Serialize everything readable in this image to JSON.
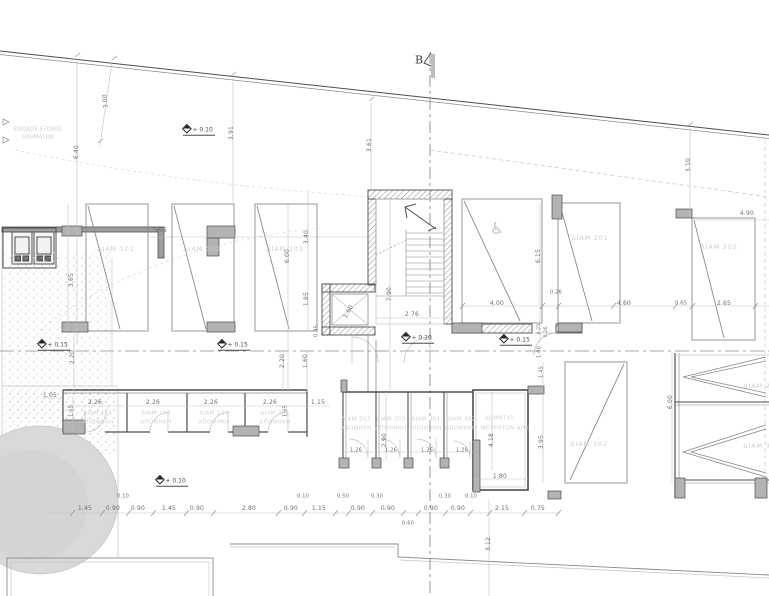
{
  "drawing": {
    "kind": "architectural ground-floor parking / storage plan",
    "section_line_axis_x": 430
  },
  "colors": {
    "background": "#ffffff",
    "line_dark": "#4d4d4d",
    "line_medium": "#8a8a8a",
    "line_light": "#c2c2c2",
    "wall_fill": "#b3b3b3",
    "label_faint": "#cdcdcd",
    "dim_text": "#6e6e6e",
    "tree_fill": "#d9d9d9"
  },
  "layers": {
    "section": {
      "label": "B",
      "x": 419,
      "y": 60
    },
    "notes": [
      {
        "t": "ΕΙΣΟΔΟΣ-ΕΞΟΔΟΣ",
        "x": 38,
        "y": 130
      },
      {
        "t": "ΟΧΗΜΑΤΩΝ",
        "x": 38,
        "y": 138
      }
    ],
    "icons": [
      {
        "t": "♿",
        "x": 497,
        "y": 229
      }
    ],
    "parking_labels": [
      {
        "t": "ΔΙΑΜ 101",
        "x": 116,
        "y": 249
      },
      {
        "t": "ΔΙΑΜ 102",
        "x": 202,
        "y": 249
      },
      {
        "t": "ΔΙΑΜ 103",
        "x": 285,
        "y": 249
      },
      {
        "t": "ΔΙΑΜ 201",
        "x": 590,
        "y": 238
      },
      {
        "t": "ΔΙΑΜ 202",
        "x": 719,
        "y": 247
      },
      {
        "t": "ΔΙΑΜ 302",
        "x": 589,
        "y": 444
      },
      {
        "t": "ΔΙΑΜ 2",
        "x": 757,
        "y": 386
      },
      {
        "t": "ΔΙΑΜ 3",
        "x": 757,
        "y": 446
      }
    ],
    "storage_labels": [
      {
        "t": "ΔΙΑΜ 101",
        "x": 98,
        "y": 414
      },
      {
        "t": "ΑΠΟΘΗΚΗ",
        "x": 98,
        "y": 423
      },
      {
        "t": "ΔΙΑΜ 102",
        "x": 156,
        "y": 414
      },
      {
        "t": "ΑΠΟΘΗΚΗ",
        "x": 156,
        "y": 423
      },
      {
        "t": "ΔΙΑΜ 103",
        "x": 214,
        "y": 414
      },
      {
        "t": "ΑΠΟΘΗΚΗ",
        "x": 214,
        "y": 423
      },
      {
        "t": "ΔΙΑΜ 201",
        "x": 275,
        "y": 414
      },
      {
        "t": "ΑΠΟΘΗΚΗ",
        "x": 275,
        "y": 423
      },
      {
        "t": "ΔΙΑΜ 202",
        "x": 356,
        "y": 420
      },
      {
        "t": "ΑΠΟΘΗΚΗ",
        "x": 356,
        "y": 429
      },
      {
        "t": "ΔΙΑΜ 203",
        "x": 391,
        "y": 420
      },
      {
        "t": "ΑΠΟΘΗΚΗ",
        "x": 391,
        "y": 429
      },
      {
        "t": "ΔΙΑΜ 301",
        "x": 426,
        "y": 420
      },
      {
        "t": "ΑΠΟΘΗΚΗ",
        "x": 426,
        "y": 429
      },
      {
        "t": "ΔΙΑΜ 302",
        "x": 461,
        "y": 420
      },
      {
        "t": "ΑΠΟΘΗΚΗ",
        "x": 461,
        "y": 429
      },
      {
        "t": "ΔΩΜΑΤΙΟ",
        "x": 499,
        "y": 419
      },
      {
        "t": "ΜΕΤΡΗΤΩΝ ΑΗΚ",
        "x": 505,
        "y": 429
      }
    ],
    "levels": [
      {
        "t": "+ 0.10",
        "x": 183,
        "y": 130
      },
      {
        "t": "+ 0.15",
        "x": 38,
        "y": 345
      },
      {
        "t": "+ 0.15",
        "x": 218,
        "y": 345
      },
      {
        "t": "+ 0.15",
        "x": 500,
        "y": 340
      },
      {
        "t": "+ 0.20",
        "x": 402,
        "y": 338
      },
      {
        "t": "+ 0.10",
        "x": 156,
        "y": 481
      }
    ],
    "dimensions": [
      {
        "t": "6.40",
        "x": 77,
        "y": 152,
        "r": -90
      },
      {
        "t": "3.00",
        "x": 106,
        "y": 101,
        "r": -97
      },
      {
        "t": "3.91",
        "x": 232,
        "y": 133,
        "r": -90
      },
      {
        "t": "3.61",
        "x": 370,
        "y": 145,
        "r": -90
      },
      {
        "t": "3.10",
        "x": 689,
        "y": 165,
        "r": -90
      },
      {
        "t": "5.95",
        "x": 160,
        "y": 231
      },
      {
        "t": "3.65",
        "x": 72,
        "y": 280,
        "r": -90
      },
      {
        "t": "6.00",
        "x": 288,
        "y": 256,
        "r": -90
      },
      {
        "t": "3.40",
        "x": 307,
        "y": 237,
        "r": -90
      },
      {
        "t": "1.85",
        "x": 307,
        "y": 299,
        "r": -90
      },
      {
        "t": "7.90",
        "x": 390,
        "y": 294,
        "r": -90
      },
      {
        "t": "1.60",
        "x": 349,
        "y": 312,
        "r": -60
      },
      {
        "t": "2.76",
        "x": 412,
        "y": 315
      },
      {
        "t": "0.35",
        "x": 317,
        "y": 331,
        "r": -90,
        "c": "s"
      },
      {
        "t": "2.20",
        "x": 73,
        "y": 357,
        "r": -90
      },
      {
        "t": "2.20",
        "x": 283,
        "y": 361,
        "r": -90
      },
      {
        "t": "1.60",
        "x": 306,
        "y": 361,
        "r": -90
      },
      {
        "t": "1.05",
        "x": 50,
        "y": 396
      },
      {
        "t": "1.65",
        "x": 72,
        "y": 411,
        "r": -90,
        "c": "s"
      },
      {
        "t": "2.26",
        "x": 95,
        "y": 403
      },
      {
        "t": "2.26",
        "x": 153,
        "y": 403
      },
      {
        "t": "2.26",
        "x": 211,
        "y": 403
      },
      {
        "t": "2.26",
        "x": 270,
        "y": 403
      },
      {
        "t": "1.65",
        "x": 286,
        "y": 411,
        "r": -90,
        "c": "s"
      },
      {
        "t": "1.15",
        "x": 318,
        "y": 403
      },
      {
        "t": "2.90",
        "x": 385,
        "y": 440,
        "r": -90
      },
      {
        "t": "1.26",
        "x": 356,
        "y": 451,
        "c": "s"
      },
      {
        "t": "1.26",
        "x": 391,
        "y": 451,
        "c": "s"
      },
      {
        "t": "1.26",
        "x": 427,
        "y": 451,
        "c": "s"
      },
      {
        "t": "1.26",
        "x": 462,
        "y": 451,
        "c": "s"
      },
      {
        "t": "4.18",
        "x": 492,
        "y": 440,
        "r": -90
      },
      {
        "t": "1.80",
        "x": 500,
        "y": 477
      },
      {
        "t": "6.15",
        "x": 539,
        "y": 256,
        "r": -90
      },
      {
        "t": "0.26",
        "x": 556,
        "y": 293,
        "c": "s"
      },
      {
        "t": "4.00",
        "x": 497,
        "y": 304
      },
      {
        "t": "4.60",
        "x": 624,
        "y": 304
      },
      {
        "t": "0.65",
        "x": 681,
        "y": 304,
        "c": "s"
      },
      {
        "t": "2.65",
        "x": 724,
        "y": 304
      },
      {
        "t": "4.90",
        "x": 747,
        "y": 214
      },
      {
        "t": "0.25",
        "x": 540,
        "y": 329,
        "r": -90,
        "c": "xs"
      },
      {
        "t": "0.26",
        "x": 547,
        "y": 332,
        "r": -90,
        "c": "xs"
      },
      {
        "t": "1.00",
        "x": 540,
        "y": 352,
        "r": -90,
        "c": "s"
      },
      {
        "t": "1.45",
        "x": 542,
        "y": 372,
        "r": -90,
        "c": "s"
      },
      {
        "t": "3.95",
        "x": 542,
        "y": 442,
        "r": -90
      },
      {
        "t": "6.00",
        "x": 671,
        "y": 402,
        "r": -90
      },
      {
        "t": "3.12",
        "x": 489,
        "y": 544,
        "r": -90
      },
      {
        "t": "1.45",
        "x": 85,
        "y": 509
      },
      {
        "t": "0.90",
        "x": 113,
        "y": 509
      },
      {
        "t": "0.90",
        "x": 138,
        "y": 509
      },
      {
        "t": "1.45",
        "x": 169,
        "y": 509
      },
      {
        "t": "0.90",
        "x": 197,
        "y": 509
      },
      {
        "t": "2.80",
        "x": 249,
        "y": 509
      },
      {
        "t": "0.90",
        "x": 291,
        "y": 509
      },
      {
        "t": "1.15",
        "x": 319,
        "y": 509
      },
      {
        "t": "0.90",
        "x": 358,
        "y": 509
      },
      {
        "t": "0.90",
        "x": 388,
        "y": 509
      },
      {
        "t": "0.90",
        "x": 431,
        "y": 509
      },
      {
        "t": "0.90",
        "x": 458,
        "y": 509
      },
      {
        "t": "2.15",
        "x": 502,
        "y": 509
      },
      {
        "t": "0.75",
        "x": 538,
        "y": 509
      },
      {
        "t": "0.10",
        "x": 123,
        "y": 497,
        "c": "s"
      },
      {
        "t": "0.10",
        "x": 303,
        "y": 497,
        "c": "s"
      },
      {
        "t": "0.50",
        "x": 343,
        "y": 497,
        "c": "s"
      },
      {
        "t": "0.30",
        "x": 377,
        "y": 497,
        "c": "s"
      },
      {
        "t": "0.30",
        "x": 445,
        "y": 497,
        "c": "s"
      },
      {
        "t": "0.10",
        "x": 471,
        "y": 497,
        "c": "s"
      },
      {
        "t": "0.60",
        "x": 408,
        "y": 524,
        "c": "s"
      }
    ]
  }
}
